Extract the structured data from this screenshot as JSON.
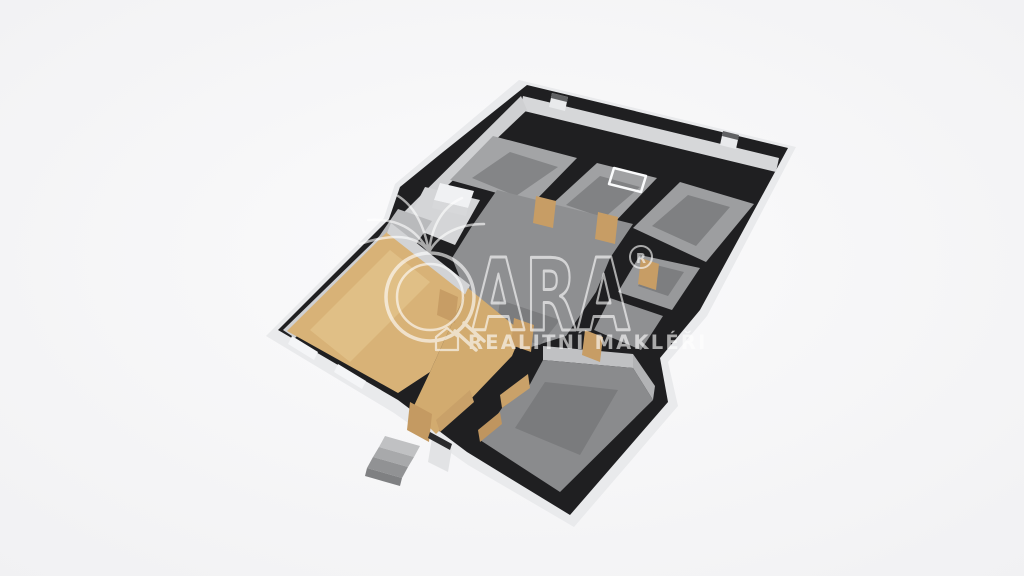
{
  "scene": {
    "description": "3D isometric floor plan render of a house interior",
    "canvas": {
      "width": 1024,
      "height": 576
    }
  },
  "palette": {
    "background_center": "#fbfbfc",
    "background_edge": "#f1f1f3",
    "wall_top": "#1f1f21",
    "outer_wall": "#e9eaec",
    "inner_wall_lit": "#d6d7d9",
    "inner_wall_shade": "#cfd0d2",
    "floor_gray": "#9b9c9e",
    "floor_gray_dark": "#7d7e80",
    "floor_wood": "#d8b277",
    "door_wood": "#c79d65",
    "watermark": "#ffffff"
  },
  "watermark": {
    "brand": "ARA",
    "registered": "R",
    "tagline": "REALITNÍ MAKLÉŘI",
    "color": "#ffffff",
    "opacity": 0.62,
    "shapes": [
      {
        "name": "q-outer-circle",
        "type": "circle",
        "cx": 430,
        "cy": 297,
        "r": 44,
        "stroke": "#ffffff",
        "sw": 3.5
      },
      {
        "name": "q-inner-circle",
        "type": "circle",
        "cx": 430,
        "cy": 297,
        "r": 33,
        "stroke": "#ffffff",
        "sw": 2.5
      },
      {
        "name": "q-tail",
        "type": "path",
        "d": "M455,331 L476,350 M464,323 L484,341",
        "stroke": "#ffffff",
        "sw": 3.5
      },
      {
        "name": "palm-icon",
        "type": "path",
        "d": "M429,252 C418,236 396,232 360,244 M429,252 C416,228 396,218 368,220 M429,252 C424,224 414,206 398,196 M429,252 C432,224 444,206 462,198 M429,252 C440,232 462,224 484,224",
        "stroke": "#ffffff",
        "sw": 2.5
      },
      {
        "name": "brand-text",
        "type": "text",
        "bind": "watermark.brand",
        "x": 472,
        "y": 330,
        "size": 100,
        "weight": "bold",
        "textLength": 158,
        "stroke": "#ffffff",
        "sw": 3,
        "fill": "none"
      },
      {
        "name": "registered-circle",
        "type": "circle",
        "cx": 641,
        "cy": 257,
        "r": 11,
        "stroke": "#ffffff",
        "sw": 2
      },
      {
        "name": "registered-text",
        "type": "text",
        "bind": "watermark.registered",
        "x": 641,
        "y": 263,
        "size": 13,
        "weight": "bold",
        "anchor": "middle",
        "fill": "#ffffff"
      },
      {
        "name": "house-icon",
        "type": "path",
        "d": "M436,350 L436,337 L447,328 L458,337 L458,350 Z",
        "stroke": "#ffffff",
        "sw": 2.2
      },
      {
        "name": "tagline-text",
        "type": "text",
        "bind": "watermark.tagline",
        "x": 468,
        "y": 349,
        "size": 19.5,
        "weight": "bold",
        "spacing": 2.2,
        "fill": "#ffffff"
      }
    ]
  },
  "floorplan": {
    "shapes": [
      {
        "name": "outer-wall-faces",
        "type": "polygon",
        "points": "519,80 796,147 707,316 668,362 678,406 574,527 468,465 394,413 266,336 384,218 395,184 438,148",
        "fill": "#e9eaec"
      },
      {
        "name": "wall-top-plate",
        "type": "polygon",
        "points": "527,85 788,148 700,310 660,358 668,402 570,515 467,452 398,400 278,330 389,219 400,187 443,152",
        "fill": "#1f1f21"
      },
      {
        "name": "ne-wall-inner-face",
        "type": "polygon",
        "points": "523,96 779,158 776,172 520,110",
        "fill": "#d6d7d9"
      },
      {
        "name": "nw-wall-inner-face-upper",
        "type": "polygon",
        "points": "521,96 527,110 407,224 398,218",
        "fill": "#cfd0d2"
      },
      {
        "name": "nw-wall-inner-face-lower",
        "type": "polygon",
        "points": "398,218 410,228 295,338 283,330",
        "fill": "#cfd0d2"
      },
      {
        "name": "room-a-floor",
        "type": "polygon",
        "points": "450,180 493,136 577,158 533,203",
        "fill": "#a3a4a6"
      },
      {
        "name": "room-a-floor-inset",
        "type": "polygon",
        "points": "472,178 510,152 558,167 516,196",
        "fill": "#848587"
      },
      {
        "name": "room-b-floor",
        "type": "polygon",
        "points": "549,207 597,163 657,178 612,225",
        "fill": "#a0a1a3"
      },
      {
        "name": "room-b-floor-inset",
        "type": "polygon",
        "points": "566,205 600,176 640,187 604,218",
        "fill": "#818284"
      },
      {
        "name": "room-c-floor",
        "type": "polygon",
        "points": "633,228 680,182 754,204 706,262",
        "fill": "#9d9ea0"
      },
      {
        "name": "room-c-floor-inset",
        "type": "polygon",
        "points": "652,226 688,195 730,207 696,246",
        "fill": "#7f8082"
      },
      {
        "name": "door-frame-on-floor",
        "type": "path",
        "d": "M614,168 L646,176 L641,192 L609,184 Z",
        "stroke": "#fafbfc",
        "sw": 2.5,
        "fill": "none"
      },
      {
        "name": "room-e-floor",
        "type": "polygon",
        "points": "640,255 700,268 672,310 618,292",
        "fill": "#98999b"
      },
      {
        "name": "room-e-floor-inset",
        "type": "polygon",
        "points": "652,264 684,272 668,296 638,286",
        "fill": "#7d7e80"
      },
      {
        "name": "room-f-floor",
        "type": "polygon",
        "points": "610,298 663,316 641,350 594,330",
        "fill": "#8f9092"
      },
      {
        "name": "hall-floor",
        "type": "polygon",
        "points": "497,190 633,224 610,258 596,292 566,336 528,348 492,330 468,298 452,258 472,226",
        "fill": "#8e8f91"
      },
      {
        "name": "hall-floor-shade",
        "type": "polygon",
        "points": "500,300 560,320 540,345 496,330",
        "fill": "#7b7c7e"
      },
      {
        "name": "bath-floor",
        "type": "polygon",
        "points": "405,225 425,187 480,200 455,245",
        "fill": "#d4d5d7"
      },
      {
        "name": "bathtub",
        "type": "polygon",
        "points": "440,183 474,191 468,208 434,200",
        "fill": "#f0f1f3"
      },
      {
        "name": "bathtub-face",
        "type": "polygon",
        "points": "434,200 468,208 466,216 432,208",
        "fill": "#d7d8da"
      },
      {
        "name": "closet-floor",
        "type": "polygon",
        "points": "378,238 398,209 432,221 410,253",
        "fill": "#b9babc"
      },
      {
        "name": "wood-room-floor",
        "type": "polygon",
        "points": "390,229 468,288 430,372 398,393 287,331",
        "fill": "#d8b277"
      },
      {
        "name": "wood-room-floor-light",
        "type": "polygon",
        "points": "310,330 390,250 430,282 350,362",
        "fill": "#e0bf86"
      },
      {
        "name": "wood-room-ne-wall-face",
        "type": "polygon",
        "points": "391,223 470,285 466,295 387,233",
        "fill": "#d2d3d5"
      },
      {
        "name": "vestibule-floor",
        "type": "polygon",
        "points": "468,288 522,332 512,356 468,402 436,434 412,410 430,372",
        "fill": "#d2ab6f"
      },
      {
        "name": "g-room-ne-wall-face",
        "type": "polygon",
        "points": "543,346 633,354 633,368 543,360",
        "fill": "#c0c1c3"
      },
      {
        "name": "g-room-e-wall-face",
        "type": "polygon",
        "points": "633,354 655,386 653,400 633,368",
        "fill": "#b2b3b5"
      },
      {
        "name": "g-room-floor",
        "type": "polygon",
        "points": "543,360 633,368 653,400 560,492 480,440 502,408 528,388",
        "fill": "#8a8b8d"
      },
      {
        "name": "g-room-floor-inset",
        "type": "polygon",
        "points": "545,382 618,390 580,455 515,428",
        "fill": "#7a7b7d"
      },
      {
        "name": "wood-wall-face-1",
        "type": "polygon",
        "points": "500,395 528,374 530,388 502,408",
        "fill": "#c9a169"
      },
      {
        "name": "wood-wall-face-2",
        "type": "polygon",
        "points": "478,430 500,412 502,424 480,442",
        "fill": "#bf955f"
      },
      {
        "name": "wood-wall-face-3",
        "type": "polygon",
        "points": "436,420 470,390 474,402 440,432",
        "fill": "#c9a169"
      },
      {
        "name": "door-panel-1",
        "type": "polygon",
        "points": "536,196 556,201 553,228 533,223",
        "fill": "#c79d65"
      },
      {
        "name": "door-panel-2",
        "type": "polygon",
        "points": "598,212 618,217 615,244 595,239",
        "fill": "#c79d65"
      },
      {
        "name": "door-panel-3",
        "type": "polygon",
        "points": "641,258 659,264 656,290 638,284",
        "fill": "#c79d65"
      },
      {
        "name": "door-panel-4",
        "type": "polygon",
        "points": "514,318 534,325 531,352 511,345",
        "fill": "#c79d65"
      },
      {
        "name": "door-panel-5",
        "type": "polygon",
        "points": "440,289 458,297 455,323 437,315",
        "fill": "#c79d65"
      },
      {
        "name": "door-panel-6",
        "type": "polygon",
        "points": "585,330 603,337 600,362 582,355",
        "fill": "#c79d65"
      },
      {
        "name": "entrance-door",
        "type": "polygon",
        "points": "410,402 432,414 429,442 407,430",
        "fill": "#c49a62"
      },
      {
        "name": "window-sill-1",
        "type": "polygon",
        "points": "292,336 318,352 314,360 288,344",
        "fill": "#f4f5f7"
      },
      {
        "name": "window-sill-2",
        "type": "polygon",
        "points": "338,364 366,381 362,389 334,372",
        "fill": "#f4f5f7"
      },
      {
        "name": "porch-wall-face",
        "type": "polygon",
        "points": "432,438 452,448 448,472 428,462",
        "fill": "#e2e3e5"
      },
      {
        "name": "porch-wall-top",
        "type": "polygon",
        "points": "430,432 452,444 450,450 428,438",
        "fill": "#2a2a2c"
      },
      {
        "name": "step-1",
        "type": "polygon",
        "points": "385,436 420,446 414,457 379,447",
        "fill": "#c0c1c3"
      },
      {
        "name": "step-2",
        "type": "polygon",
        "points": "379,447 414,457 408,467 373,457",
        "fill": "#a8a9ab"
      },
      {
        "name": "step-3",
        "type": "polygon",
        "points": "373,457 408,467 402,478 367,468",
        "fill": "#919294"
      },
      {
        "name": "steps-side-face",
        "type": "polygon",
        "points": "367,468 402,478 400,486 365,476",
        "fill": "#7f8082"
      },
      {
        "name": "chimney-1-body",
        "type": "polygon",
        "points": "552,93 568,97 565,111 549,107",
        "fill": "#e9eaec"
      },
      {
        "name": "chimney-1-cap",
        "type": "polygon",
        "points": "552,93 568,97 567,102 551,98",
        "fill": "#606163"
      },
      {
        "name": "chimney-2-body",
        "type": "polygon",
        "points": "723,131 739,135 736,149 720,145",
        "fill": "#e9eaec"
      },
      {
        "name": "chimney-2-cap",
        "type": "polygon",
        "points": "723,131 739,135 738,140 722,136",
        "fill": "#606163"
      }
    ]
  }
}
